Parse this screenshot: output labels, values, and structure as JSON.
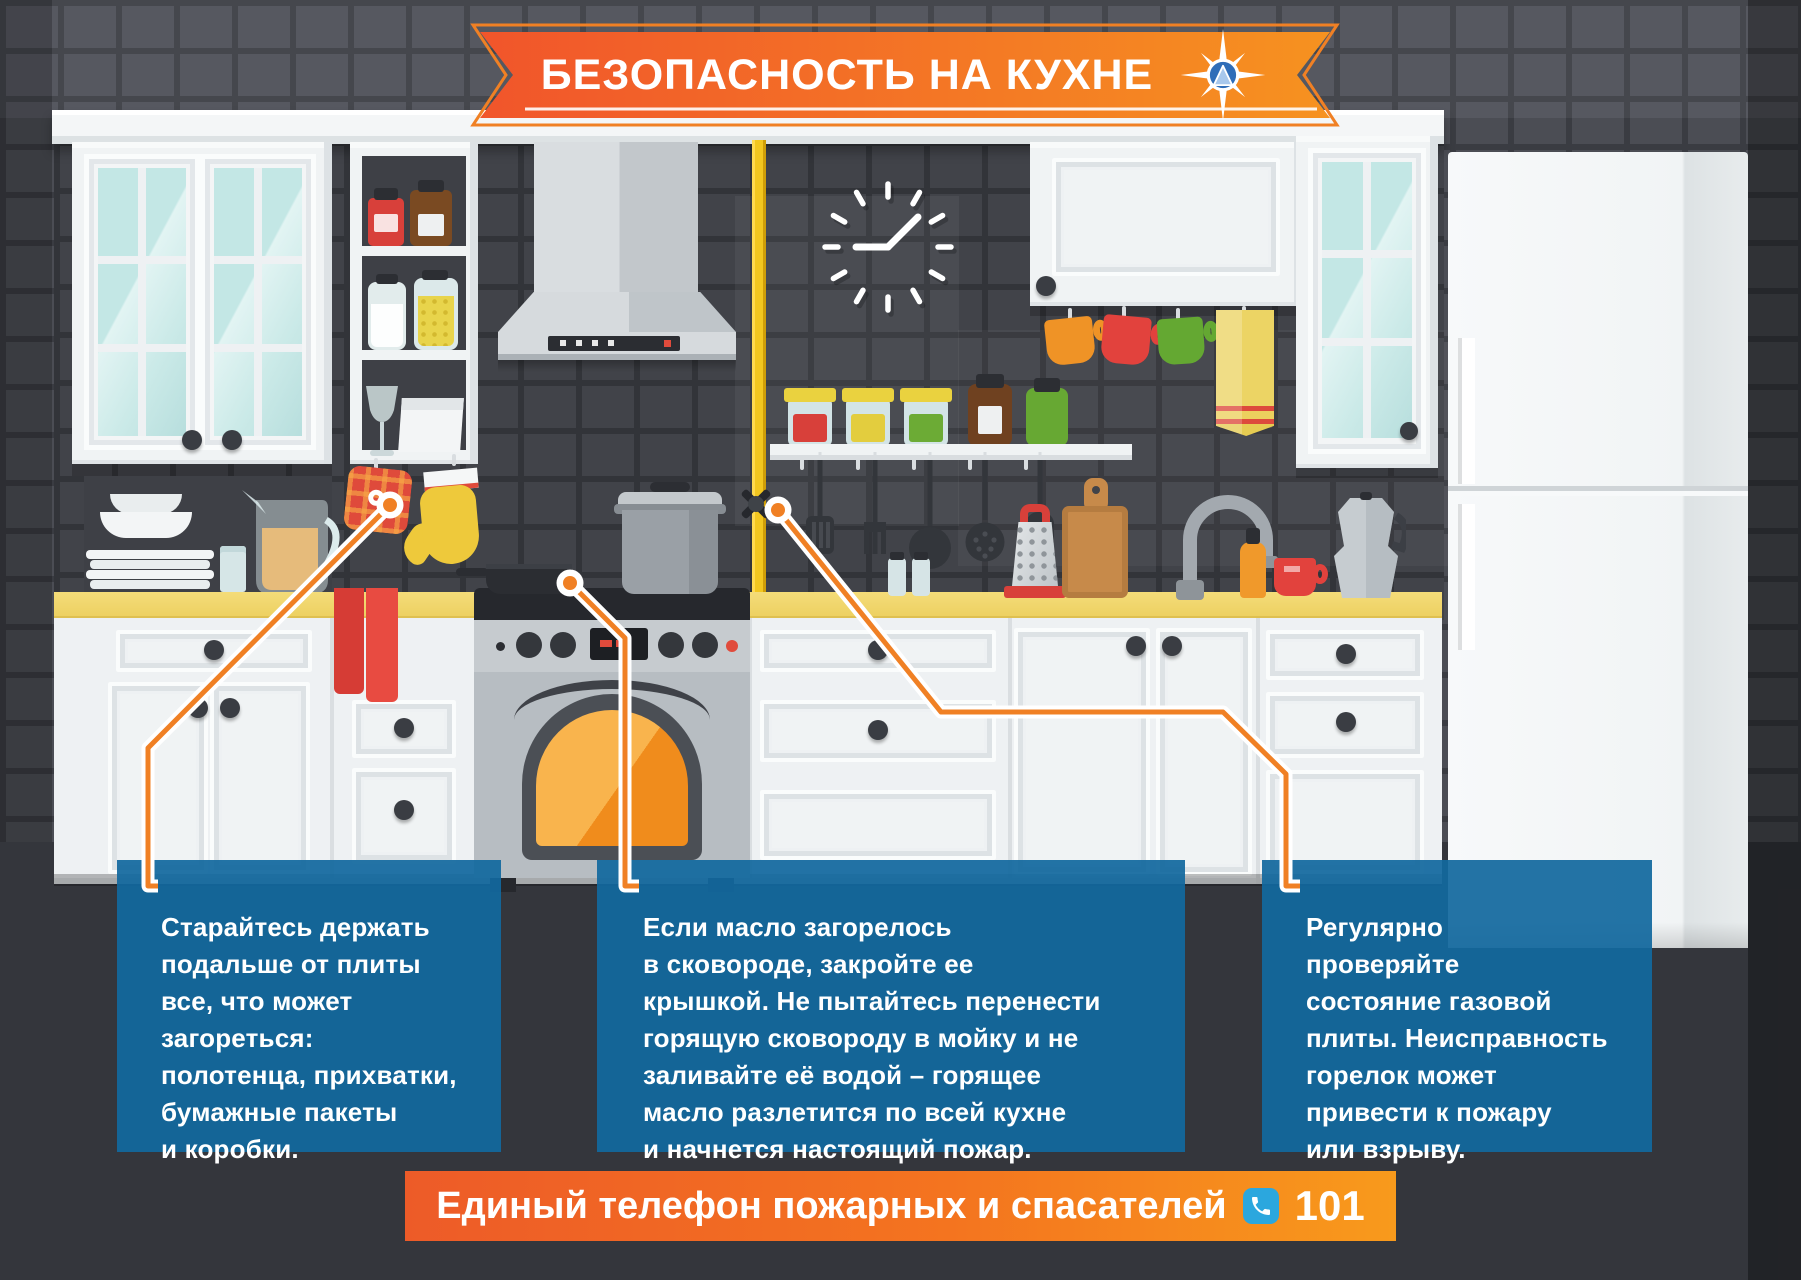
{
  "banner": {
    "title": "БЕЗОПАСНОСТЬ НА КУХНЕ",
    "emblem_icon": "emercom-compass-star-icon"
  },
  "tips": [
    {
      "text": "Старайтесь держать\nподальше от плиты\nвсе, что может\nзагореться:\nполотенца, прихватки,\nбумажные пакеты\nи коробки."
    },
    {
      "text": "Если масло загорелось\nв сковороде, закройте ее\nкрышкой. Не пытайтесь перенести\nгорящую сковороду в мойку и не\nзаливайте её водой – горящее\nмасло разлетится по всей кухне\nи начнется настоящий пожар."
    },
    {
      "text": "Регулярно\nпроверяйте\nсостояние газовой\nплиты. Неисправность\nгорелок может\nпривести к пожару\nили взрыву."
    }
  ],
  "footer": {
    "label": "Единый телефон пожарных и спасателей",
    "phone": "101",
    "phone_icon": "phone-receiver-icon"
  },
  "colors": {
    "banner_orange_start": "#f1552b",
    "banner_orange_end": "#f69220",
    "callout_blue": "#12689e",
    "phone_badge_blue": "#2ba7de",
    "connector_orange": "#f08024",
    "counter_yellow": "#f2d96e",
    "gas_pipe_yellow": "#f2c61f",
    "oven_glow_orange": "#f6a33c"
  }
}
